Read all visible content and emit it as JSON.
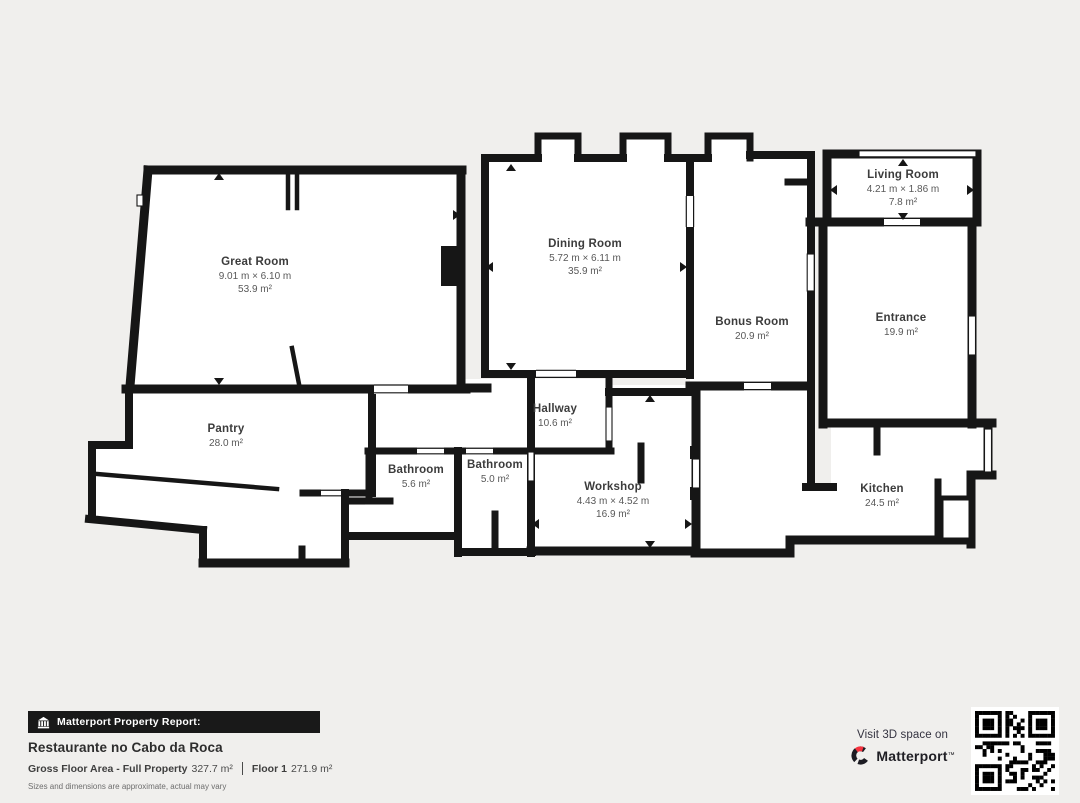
{
  "plan": {
    "background": "#f0efed",
    "wall_color": "#161616",
    "room_fill": "#ffffff",
    "rooms": [
      {
        "id": "great-room",
        "name": "Great Room",
        "dimensions": "9.01 m × 6.10 m",
        "area": "53.9 m²",
        "label_x": 255,
        "label_y": 256
      },
      {
        "id": "dining-room",
        "name": "Dining Room",
        "dimensions": "5.72 m × 6.11 m",
        "area": "35.9 m²",
        "label_x": 585,
        "label_y": 238
      },
      {
        "id": "living-room",
        "name": "Living Room",
        "dimensions": "4.21 m × 1.86 m",
        "area": "7.8 m²",
        "label_x": 903,
        "label_y": 169
      },
      {
        "id": "bonus-room",
        "name": "Bonus Room",
        "dimensions": "",
        "area": "20.9 m²",
        "label_x": 752,
        "label_y": 316
      },
      {
        "id": "entrance",
        "name": "Entrance",
        "dimensions": "",
        "area": "19.9 m²",
        "label_x": 901,
        "label_y": 312
      },
      {
        "id": "pantry",
        "name": "Pantry",
        "dimensions": "",
        "area": "28.0 m²",
        "label_x": 226,
        "label_y": 423
      },
      {
        "id": "hallway",
        "name": "Hallway",
        "dimensions": "",
        "area": "10.6 m²",
        "label_x": 555,
        "label_y": 403
      },
      {
        "id": "bathroom-1",
        "name": "Bathroom",
        "dimensions": "",
        "area": "5.6 m²",
        "label_x": 416,
        "label_y": 464
      },
      {
        "id": "bathroom-2",
        "name": "Bathroom",
        "dimensions": "",
        "area": "5.0 m²",
        "label_x": 495,
        "label_y": 459
      },
      {
        "id": "workshop",
        "name": "Workshop",
        "dimensions": "4.43 m × 4.52 m",
        "area": "16.9 m²",
        "label_x": 613,
        "label_y": 481
      },
      {
        "id": "kitchen",
        "name": "Kitchen",
        "dimensions": "",
        "area": "24.5 m²",
        "label_x": 882,
        "label_y": 483
      }
    ]
  },
  "footer": {
    "icon": "building-icon",
    "banner_label": "Matterport Property Report:",
    "property_title": "Restaurante no Cabo da Roca",
    "gross_label": "Gross Floor Area - Full Property",
    "gross_value": "327.7 m²",
    "floor_label": "Floor 1",
    "floor_value": "271.9 m²",
    "disclaimer": "Sizes and dimensions are approximate, actual may vary"
  },
  "cta": {
    "text": "Visit 3D space on",
    "brand": "Matterport",
    "trademark": "™",
    "logo_icon": "matterport-logo-icon",
    "brand_red": "#f6323e",
    "qr_icon": "qr-code"
  }
}
